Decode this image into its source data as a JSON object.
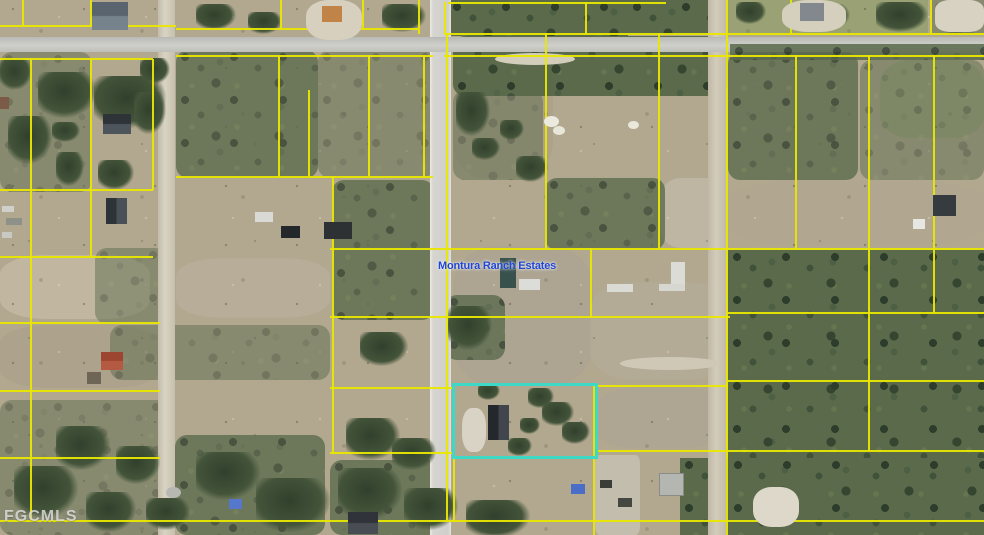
{
  "map_image": {
    "type": "aerial-parcel-map",
    "subdivision_label": "Montura Ranch Estates",
    "watermark": "FGCMLS",
    "highlighted_parcel": {
      "x": 452,
      "y": 383,
      "width": 146,
      "height": 76
    },
    "roads": {
      "horizontal_road_y": 37,
      "vertical_paved_road_x": 430,
      "vertical_dirt_road_left_x": 158,
      "vertical_dirt_road_right_x": 708
    },
    "colors": {
      "parcel_line_yellow": "#e9e700",
      "highlight_cyan": "#3dd8c6",
      "label_blue": "#2346d2",
      "watermark_gray": "#e4e4e4",
      "paved_road_gray": "#d6d5d0",
      "dirt_road_tan": "#d3ccba",
      "field_tan": "#b2a88f",
      "forest_green": "#5a6a4b"
    }
  }
}
